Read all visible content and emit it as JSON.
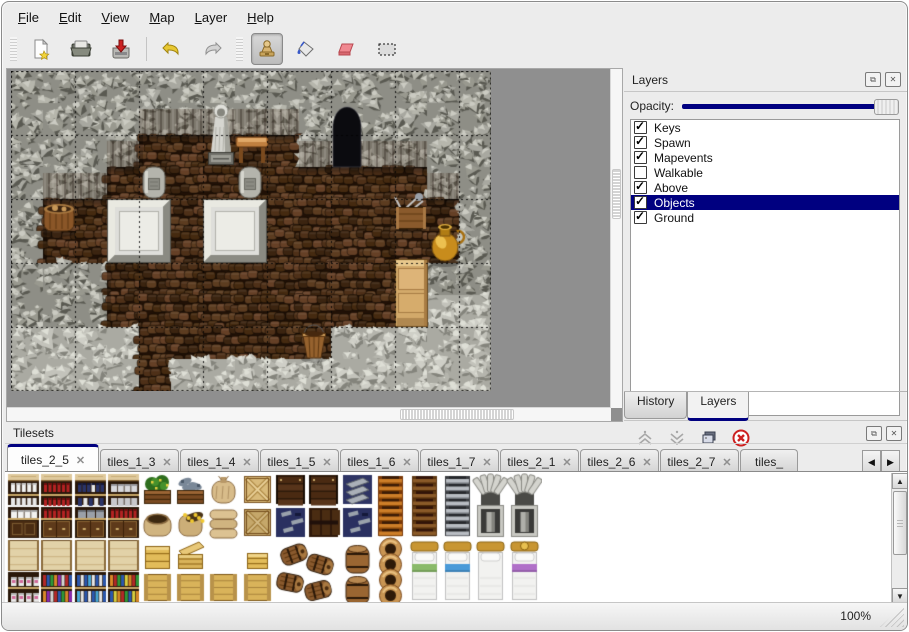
{
  "accent": "#000080",
  "menu": {
    "items": [
      {
        "label": "File"
      },
      {
        "label": "Edit"
      },
      {
        "label": "View"
      },
      {
        "label": "Map"
      },
      {
        "label": "Layer"
      },
      {
        "label": "Help"
      }
    ]
  },
  "toolbar": {
    "tools": [
      {
        "name": "new-file"
      },
      {
        "name": "open-file"
      },
      {
        "name": "save-file"
      },
      {
        "name": "undo"
      },
      {
        "name": "redo"
      },
      {
        "name": "stamp-tool",
        "active": true
      },
      {
        "name": "fill-tool"
      },
      {
        "name": "eraser-tool"
      },
      {
        "name": "rect-select-tool"
      }
    ]
  },
  "layers_panel": {
    "title": "Layers",
    "opacity_label": "Opacity:",
    "opacity_percent": 100,
    "layers": [
      {
        "name": "Keys",
        "visible": true,
        "selected": false
      },
      {
        "name": "Spawn",
        "visible": true,
        "selected": false
      },
      {
        "name": "Mapevents",
        "visible": true,
        "selected": false
      },
      {
        "name": "Walkable",
        "visible": false,
        "selected": false
      },
      {
        "name": "Above",
        "visible": true,
        "selected": false
      },
      {
        "name": "Objects",
        "visible": true,
        "selected": true
      },
      {
        "name": "Ground",
        "visible": true,
        "selected": false
      }
    ],
    "buttons": [
      {
        "name": "move-layer-up"
      },
      {
        "name": "move-layer-down"
      },
      {
        "name": "duplicate-layer"
      },
      {
        "name": "delete-layer"
      }
    ],
    "tabs": [
      {
        "label": "History",
        "active": false
      },
      {
        "label": "Layers",
        "active": true
      }
    ]
  },
  "tilesets_panel": {
    "title": "Tilesets",
    "tabs": [
      {
        "label": "tiles_2_5",
        "active": true
      },
      {
        "label": "tiles_1_3",
        "active": false
      },
      {
        "label": "tiles_1_4",
        "active": false
      },
      {
        "label": "tiles_1_5",
        "active": false
      },
      {
        "label": "tiles_1_6",
        "active": false
      },
      {
        "label": "tiles_1_7",
        "active": false
      },
      {
        "label": "tiles_2_1",
        "active": false
      },
      {
        "label": "tiles_2_6",
        "active": false
      },
      {
        "label": "tiles_2_7",
        "active": false
      },
      {
        "label": "tiles_",
        "active": false
      }
    ]
  },
  "statusbar": {
    "zoom": "100%"
  },
  "map": {
    "tile": 32,
    "cols": 15,
    "rows": 10,
    "grid": [
      "WWWWWWWWWWWWWWW",
      "WWWWWWWWWWWWWWW",
      "WWWWFFFFFWWWWWW",
      "WWWFFFFFFFFFFWW",
      "WFFFFFFFFFFFFFW",
      "WFFFFFFFFFFFFFW",
      "WWWFFFFFFFFFFWW",
      "WWWFFFFFFFFFFGG",
      "GGGGFFFFFFGGGGG",
      "GGGGFGGGGGGGGGG"
    ],
    "objects": [
      {
        "type": "door",
        "x": 320,
        "y": 34,
        "w": 32,
        "h": 62
      },
      {
        "type": "statue",
        "x": 194,
        "y": 30,
        "w": 32,
        "h": 64
      },
      {
        "type": "table",
        "x": 224,
        "y": 62,
        "w": 34,
        "h": 34
      },
      {
        "type": "grave",
        "x": 128,
        "y": 94,
        "w": 30,
        "h": 36
      },
      {
        "type": "grave",
        "x": 224,
        "y": 94,
        "w": 30,
        "h": 36
      },
      {
        "type": "slab",
        "x": 96,
        "y": 128,
        "w": 64,
        "h": 64
      },
      {
        "type": "slab",
        "x": 192,
        "y": 128,
        "w": 64,
        "h": 64
      },
      {
        "type": "basket",
        "x": 30,
        "y": 126,
        "w": 36,
        "h": 38
      },
      {
        "type": "crate_tools",
        "x": 382,
        "y": 124,
        "w": 36,
        "h": 36
      },
      {
        "type": "goldpot",
        "x": 416,
        "y": 152,
        "w": 36,
        "h": 42
      },
      {
        "type": "cabinet",
        "x": 384,
        "y": 188,
        "w": 33,
        "h": 68
      },
      {
        "type": "bucket",
        "x": 288,
        "y": 256,
        "w": 30,
        "h": 34
      }
    ]
  },
  "tileset": {
    "grid": [
      [
        "shelf_white",
        "shelf_red",
        "shelf_blue",
        "shelf_jars",
        "plant_box",
        "fish_box",
        "sack",
        "crate_x",
        "dark_planks",
        "dark_planks",
        "metal_stack",
        "ladder_orange",
        "ladder_brown",
        "ladder_gray",
        "arch",
        "arch"
      ],
      [
        "shelf_white2",
        "shelf_red2",
        "shelf_pots2",
        "shelf_red2",
        "sack_open",
        "sack_gold",
        "sack_stack",
        "crate_x2",
        "navy_metal",
        "dark_crate",
        "navy_metal",
        "skip",
        "skip",
        "skip",
        "skip",
        "skip"
      ],
      [
        "shelf_top",
        "shelf_top",
        "shelf_top",
        "shelf_top",
        "crate",
        "crate_lid",
        "empty",
        "crate_small",
        "barrel_pile",
        "skip",
        "barrel_stack",
        "pot_stack",
        "bed_green",
        "bed_blue",
        "bed_white",
        "bed_purple"
      ],
      [
        "shelf_jars_sm",
        "shelf_books",
        "shelf_bottles",
        "shelf_books2",
        "crate_front",
        "crate_front",
        "crate_front",
        "crate_front",
        "skip",
        "skip",
        "skip",
        "skip",
        "skip",
        "skip",
        "skip",
        "skip"
      ]
    ]
  }
}
